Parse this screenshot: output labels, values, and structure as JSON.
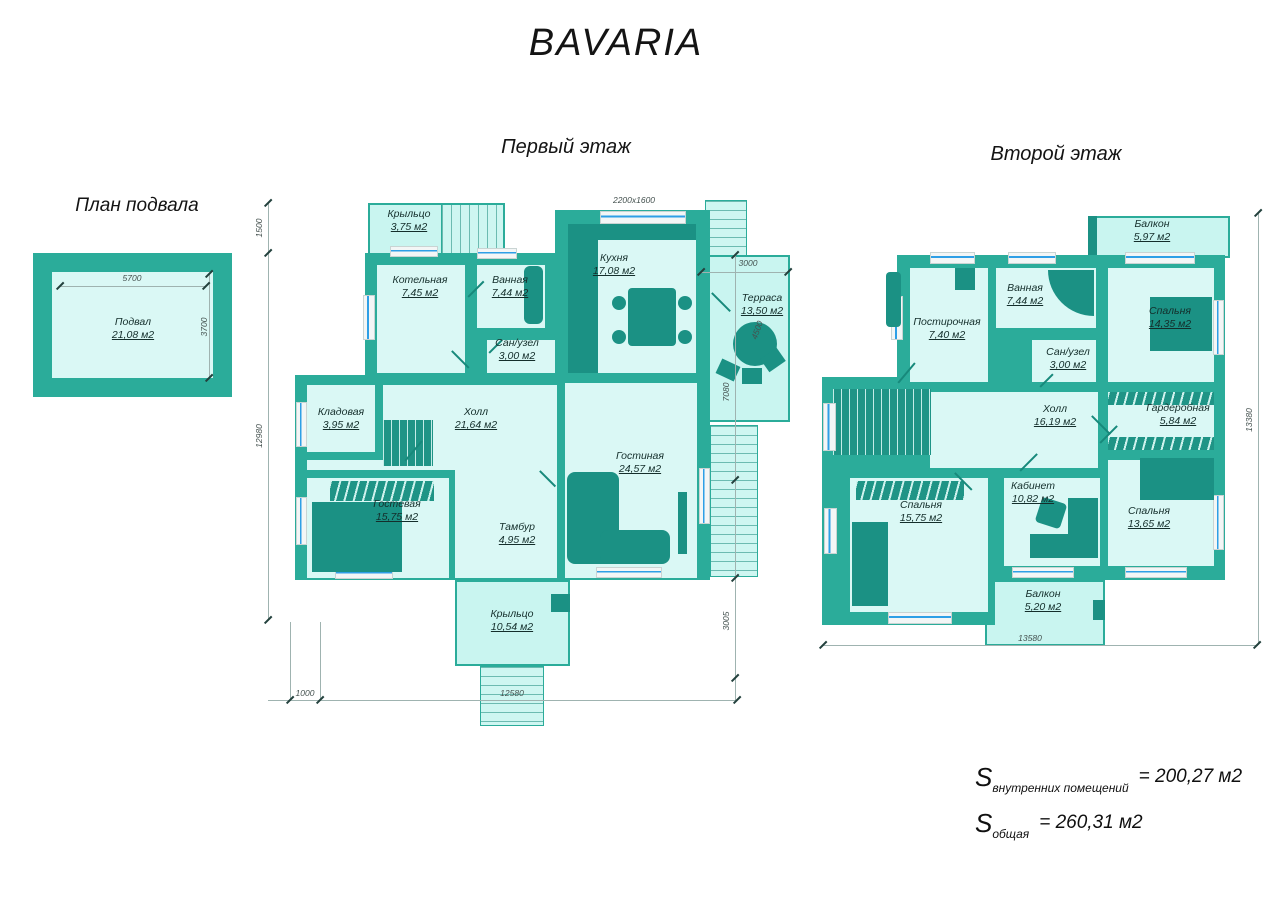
{
  "title": "BAVARIA",
  "palette": {
    "wall": "#2bac9a",
    "room_fill": "#daf8f5",
    "porch_fill": "#c9f5f0",
    "furniture": "#1b9184",
    "window_blue": "#2e9fe6"
  },
  "basement": {
    "title": "План подвала",
    "rooms": [
      {
        "name": "Подвал",
        "area": "21,08 м2"
      }
    ],
    "dims": {
      "width": "5700",
      "height": "3700"
    }
  },
  "first_floor": {
    "title": "Первый этаж",
    "rooms": [
      {
        "name": "Крыльцо",
        "area": "3,75 м2"
      },
      {
        "name": "Котельная",
        "area": "7,45 м2"
      },
      {
        "name": "Ванная",
        "area": "7,44 м2"
      },
      {
        "name": "Сан/узел",
        "area": "3,00 м2"
      },
      {
        "name": "Кухня",
        "area": "17,08 м2"
      },
      {
        "name": "Терраса",
        "area": "13,50 м2"
      },
      {
        "name": "Кладовая",
        "area": "3,95 м2"
      },
      {
        "name": "Холл",
        "area": "21,64 м2"
      },
      {
        "name": "Гостевая",
        "area": "15,75 м2"
      },
      {
        "name": "Тамбур",
        "area": "4,95 м2"
      },
      {
        "name": "Гостиная",
        "area": "24,57 м2"
      },
      {
        "name": "Крыльцо",
        "area": "10,54 м2"
      }
    ],
    "dims": {
      "kitchen_window": "2200x1600",
      "terrace_width": "3000",
      "terrace_depth": "4500",
      "left_top": "1500",
      "left": "12980",
      "bottom_left": "1000",
      "bottom": "12580",
      "right_top": "7080",
      "right_bottom": "3005"
    }
  },
  "second_floor": {
    "title": "Второй этаж",
    "rooms": [
      {
        "name": "Балкон",
        "area": "5,97 м2"
      },
      {
        "name": "Постирочная",
        "area": "7,40 м2"
      },
      {
        "name": "Ванная",
        "area": "7,44 м2"
      },
      {
        "name": "Сан/узел",
        "area": "3,00 м2"
      },
      {
        "name": "Спальня",
        "area": "14,35 м2"
      },
      {
        "name": "Холл",
        "area": "16,19 м2"
      },
      {
        "name": "Гардеробная",
        "area": "5,84 м2"
      },
      {
        "name": "Спальня",
        "area": "15,75 м2"
      },
      {
        "name": "Кабинет",
        "area": "10,82 м2"
      },
      {
        "name": "Спальня",
        "area": "13,65 м2"
      },
      {
        "name": "Балкон",
        "area": "5,20 м2"
      }
    ],
    "dims": {
      "bottom": "13580",
      "right": "13380"
    }
  },
  "totals": {
    "s_symbol": "S",
    "interior_label": "внутренних помещений",
    "interior_value": "= 200,27 м2",
    "total_label": "общая",
    "total_value": "= 260,31 м2"
  }
}
